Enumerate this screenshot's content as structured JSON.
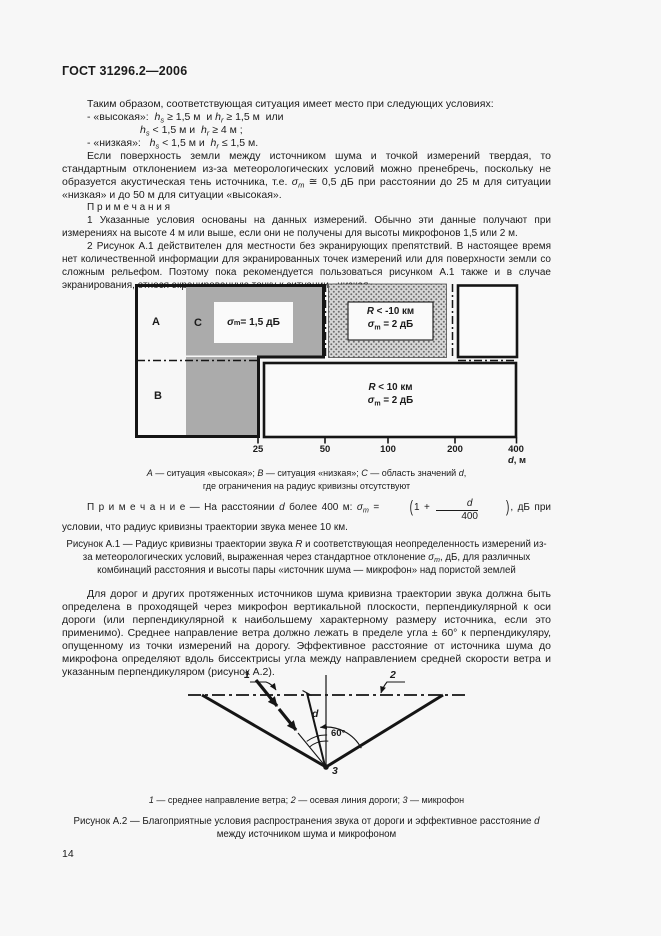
{
  "page": {
    "header": "ГОСТ 31296.2—2006",
    "number": "14"
  },
  "intro": {
    "p1": "Таким образом, соответствующая ситуация имеет место при следующих условиях:",
    "cond1": [
      {
        "t": "- «высокая»:  "
      },
      {
        "t": "h",
        "i": true
      },
      {
        "t": "s",
        "sub": true,
        "i": true
      },
      {
        "t": " ≥ 1,5 м  и "
      },
      {
        "t": "h",
        "i": true
      },
      {
        "t": "r",
        "sub": true,
        "i": true
      },
      {
        "t": " ≥ 1,5 м  или"
      }
    ],
    "cond2": [
      {
        "t": "h",
        "i": true
      },
      {
        "t": "s",
        "sub": true,
        "i": true
      },
      {
        "t": " < 1,5 м и  "
      },
      {
        "t": "h",
        "i": true
      },
      {
        "t": "r",
        "sub": true,
        "i": true
      },
      {
        "t": " ≥ 4 м ;"
      }
    ],
    "cond3": [
      {
        "t": "- «низкая»:   "
      },
      {
        "t": "h",
        "i": true
      },
      {
        "t": "s",
        "sub": true,
        "i": true
      },
      {
        "t": " < 1,5 м и  "
      },
      {
        "t": "h",
        "i": true
      },
      {
        "t": "r",
        "sub": true,
        "i": true
      },
      {
        "t": " ≤ 1,5 м."
      }
    ],
    "p2": [
      {
        "t": "Если поверхность земли между источником шума и точкой измерений твердая, то стандартным отклонением из-за метеорологических условий можно пренебречь, поскольку не образуется акустическая тень источника, т.е. "
      },
      {
        "t": "σ",
        "i": true
      },
      {
        "t": "m",
        "sub": true,
        "i": true
      },
      {
        "t": " ≅ 0,5  дБ при расстоянии до 25 м для ситуации «низкая» и до 50 м для ситуации «высокая»."
      }
    ]
  },
  "notes": {
    "title": "П р и м е ч а н и я",
    "n1": "1 Указанные условия основаны на данных измерений.  Обычно эти данные получают при измерениях на высоте 4 м или выше,  если они не получены для высоты микрофонов  1,5  или 2 м.",
    "n2": "2 Рисунок А.1 действителен для местности без экранирующих препятствий. В настоящее время нет количественной информации для экранированных точек измерений или для поверхности земли со сложным рельефом. Поэтому пока рекомендуется пользоваться рисунком А.1 также и в случае экранирования, относя экранированную точку к ситуации «низкая»."
  },
  "fig1": {
    "label_a": "А",
    "label_b": "В",
    "label_c": "С",
    "box_c": [
      {
        "t": "σ",
        "i": true
      },
      {
        "t": "m",
        "sub": true
      },
      {
        "t": " = 1,5 дБ"
      }
    ],
    "box_top_l1": [
      {
        "t": "R",
        "i": true
      },
      {
        "t": " < -10 км"
      }
    ],
    "box_top_l2": [
      {
        "t": "σ",
        "i": true
      },
      {
        "t": "m",
        "sub": true
      },
      {
        "t": " = 2 дБ"
      }
    ],
    "box_bot_l1": [
      {
        "t": "R",
        "i": true
      },
      {
        "t": " < 10 км"
      }
    ],
    "box_bot_l2": [
      {
        "t": "σ",
        "i": true
      },
      {
        "t": "m",
        "sub": true
      },
      {
        "t": " = 2 дБ"
      }
    ],
    "ticks": [
      "25",
      "50",
      "100",
      "200",
      "400"
    ],
    "unit": [
      {
        "t": "d",
        "i": true
      },
      {
        "t": ", м"
      }
    ],
    "legend_l1": [
      {
        "t": "А",
        "i": true
      },
      {
        "t": " — ситуация «высокая»; "
      },
      {
        "t": "В",
        "i": true
      },
      {
        "t": " — ситуация «низкая»; "
      },
      {
        "t": "С",
        "i": true
      },
      {
        "t": " — область значений "
      },
      {
        "t": "d",
        "i": true
      },
      {
        "t": ","
      }
    ],
    "legend_l2": "где ограничения на радиус кривизны отсутствуют",
    "note": [
      {
        "t": "П р и м е ч а н и е —  На расстоянии "
      },
      {
        "t": "d",
        "i": true
      },
      {
        "t": " более 400 м: "
      },
      {
        "t": "σ",
        "i": true
      },
      {
        "t": "m",
        "sub": true,
        "i": true
      },
      {
        "t": " = "
      },
      {
        "t": "(",
        "big": true
      },
      {
        "t": "1 + "
      },
      {
        "frac": [
          "d",
          "400"
        ]
      },
      {
        "t": ")",
        "big": true
      },
      {
        "t": ", дБ при условии, что радиус кривизны траектории звука менее 10 км."
      }
    ],
    "caption": [
      {
        "t": "Рисунок А.1 — Радиус кривизны траектории звука "
      },
      {
        "t": "R",
        "i": true
      },
      {
        "t": "  и соответствующая неопределенность измерений из-за метеорологических условий, выраженная через стандартное отклонение "
      },
      {
        "t": "σ",
        "i": true
      },
      {
        "t": "m",
        "sub": true,
        "i": true
      },
      {
        "t": ", дБ, для различных комбинаций расстояния и высоты  пары «источник шума — микрофон» над пористой землей"
      }
    ]
  },
  "para_roads": "Для дорог и других протяженных источников шума кривизна траектории звука должна быть определена в проходящей через микрофон вертикальной плоскости, перпендикулярной к оси дороги (или перпендикулярной к наибольшему характерному размеру источника, если это применимо). Среднее направление ветра должно  лежать в пределе угла ± 60° к перпендикуляру, опущенному из точки измерений на дорогу. Эффективное расстояние от источника шума  до микрофона определяют вдоль биссектрисы угла между направлением средней скорости ветра и  указанным перпендикуляром (рисунок А.2).",
  "fig2": {
    "label_1": "1",
    "label_2": "2",
    "label_3": "3",
    "label_d": "d",
    "label_angle": "60°",
    "legend": [
      {
        "t": "1",
        "i": true
      },
      {
        "t": " — среднее направление ветра; "
      },
      {
        "t": "2",
        "i": true
      },
      {
        "t": " — осевая линия дороги; "
      },
      {
        "t": "3",
        "i": true
      },
      {
        "t": " — микрофон"
      }
    ],
    "caption": [
      {
        "t": "Рисунок А.2 — Благоприятные условия распространения звука от дороги и эффективное расстояние "
      },
      {
        "t": "d",
        "i": true
      },
      {
        "t": " между источником шума и микрофоном"
      }
    ]
  },
  "colors": {
    "ink": "#1b1b1b",
    "gray_region": "#ababab",
    "page_bg": "#f7f7f7"
  }
}
